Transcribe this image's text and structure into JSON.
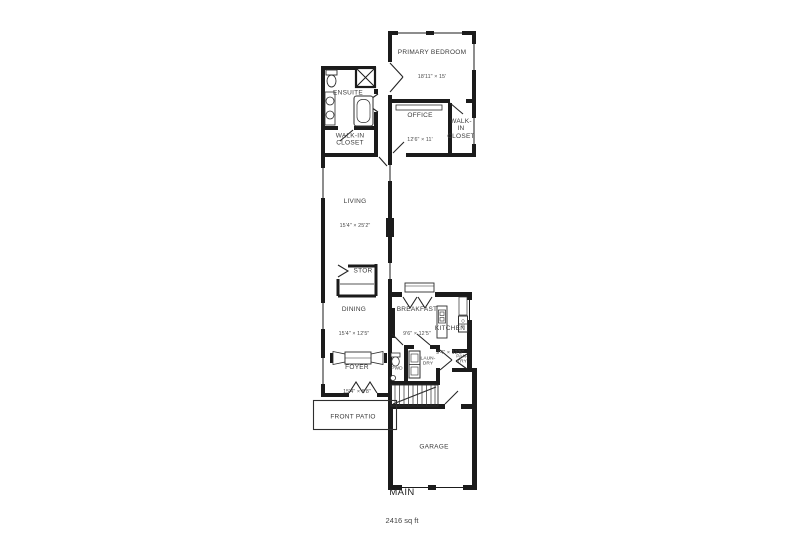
{
  "floor": {
    "label": "MAIN",
    "area": "2416 sq ft"
  },
  "rooms": {
    "primary_bedroom": {
      "name": "PRIMARY BEDROOM",
      "dims": "18'11\" × 15'"
    },
    "ensuite": {
      "name": "ENSUITE"
    },
    "walk_in_closet_primary": {
      "name": "WALK-IN\nCLOSET"
    },
    "office": {
      "name": "OFFICE",
      "dims": "12'6\" × 11'"
    },
    "walk_in_closet_hall": {
      "name": "WALK-\nIN\nCLOSET"
    },
    "living": {
      "name": "LIVING",
      "dims": "15'4\" × 25'2\""
    },
    "storage": {
      "name": "STOR"
    },
    "dining": {
      "name": "DINING",
      "dims": "15'4\" × 12'5\""
    },
    "breakfast": {
      "name": "BREAKFAST",
      "dims": "9'6\" × 12'5\""
    },
    "kitchen": {
      "name": "KITCHEN",
      "dims": "9'4\" × 12'5\""
    },
    "pantry": {
      "name": "PAN-\nTRY"
    },
    "laundry": {
      "name": "LAUN-\nDRY"
    },
    "powder": {
      "name": "PWD"
    },
    "oven": {
      "name": "OV"
    },
    "foyer": {
      "name": "FOYER",
      "dims": "15'4\" × 8'8\""
    },
    "front_patio": {
      "name": "FRONT PATIO"
    },
    "garage": {
      "name": "GARAGE"
    }
  },
  "colors": {
    "wall": "#1b1b1b",
    "fixture": "#2e2e2e",
    "text": "#3a3a3a",
    "background": "#ffffff"
  }
}
